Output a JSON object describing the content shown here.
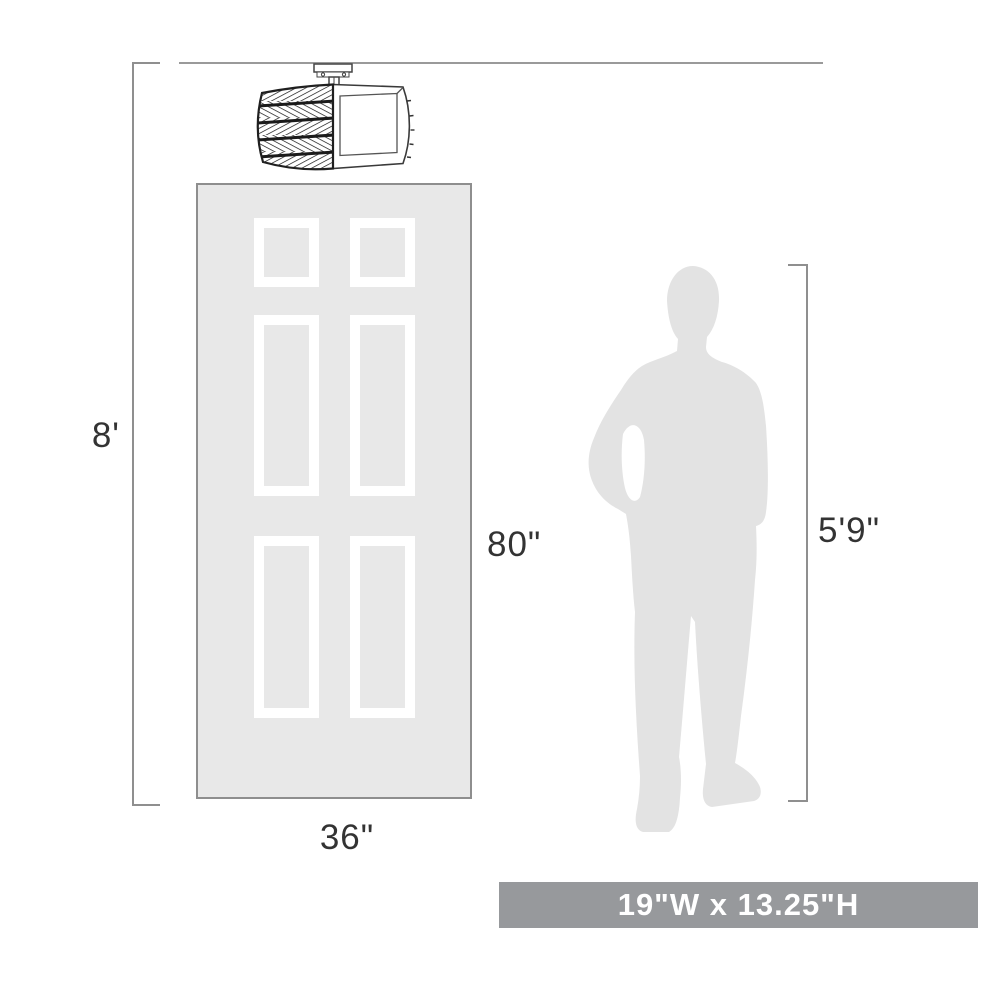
{
  "scale_diagram": {
    "ceiling_height_label": "8'",
    "door_height_label": "80\"",
    "door_width_label": "36\"",
    "person_height_label": "5'9\"",
    "fixture_size_label": "19\"W x 13.25\"H",
    "icons": {
      "fixture": "crystal-drum-flush-mount-light",
      "door": "six-panel-door",
      "person": "man-silhouette"
    },
    "colors": {
      "door_fill": "#e8e8e8",
      "door_border": "#8e8e8e",
      "panel_frame": "#ffffff",
      "silhouette_fill": "#e3e3e3",
      "dimension_line": "#8f8f8f",
      "label_text": "#333333",
      "banner_bg": "#97999c",
      "banner_text": "#ffffff",
      "fixture_line": "#2f2f2f"
    }
  }
}
